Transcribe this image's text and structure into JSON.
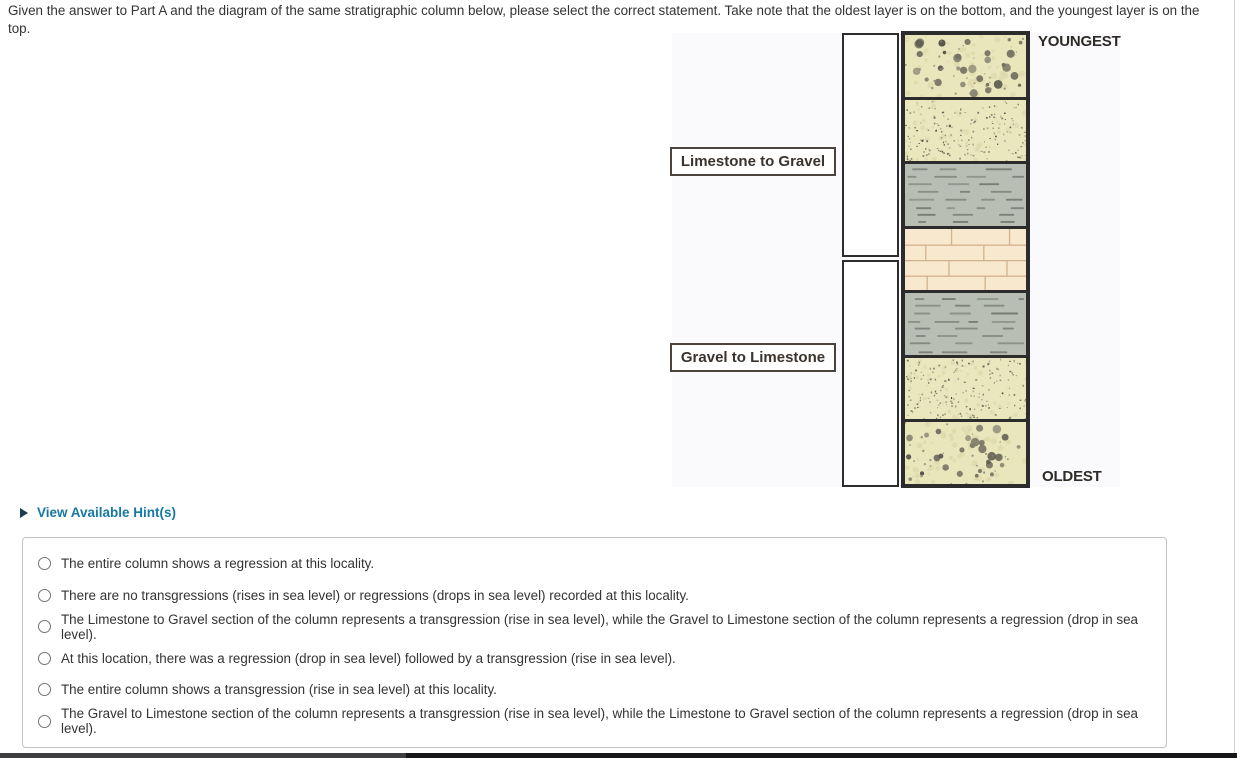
{
  "question": "Given the answer to Part A and the diagram of the same stratigraphic column below, please select the correct statement. Take note that the oldest layer is on the bottom, and the youngest layer is on the top.",
  "hint": {
    "label": "View Available Hint(s)",
    "icon": "right-triangle-icon"
  },
  "diagram": {
    "youngest_label": "YOUNGEST",
    "oldest_label": "OLDEST",
    "section_labels": [
      {
        "label": "Limestone to Gravel"
      },
      {
        "label": "Gravel to Limestone"
      }
    ],
    "layers": [
      {
        "type": "conglomerate",
        "position": "top"
      },
      {
        "type": "sandstone"
      },
      {
        "type": "shale"
      },
      {
        "type": "limestone"
      },
      {
        "type": "shale"
      },
      {
        "type": "sandstone"
      },
      {
        "type": "conglomerate",
        "position": "bottom"
      }
    ],
    "colors": {
      "conglomerate_bg": "#e9e6bc",
      "sandstone_bg": "#eae7bf",
      "shale_bg": "#b9beb5",
      "limestone_bg": "#f8e8cd",
      "outline": "#2c2c2c",
      "label_box_border": "#4b433d"
    }
  },
  "options": [
    {
      "label": "The entire column shows a regression at this locality.",
      "selected": false
    },
    {
      "label": "There are no transgressions (rises in sea level) or regressions (drops in sea level) recorded at this locality.",
      "selected": false
    },
    {
      "label": "The Limestone to Gravel section of the column represents a transgression (rise in sea level), while the Gravel to Limestone section of the column represents a regression (drop in sea level).",
      "selected": false
    },
    {
      "label": "At this location, there was a regression (drop in sea level) followed by a transgression (rise in sea level).",
      "selected": false
    },
    {
      "label": "The entire column shows a transgression (rise in sea level) at this locality.",
      "selected": false
    },
    {
      "label": "The Gravel to Limestone section of the column represents a transgression (rise in sea level), while the Limestone to Gravel section of the column represents a regression (drop in sea level).",
      "selected": false
    }
  ]
}
